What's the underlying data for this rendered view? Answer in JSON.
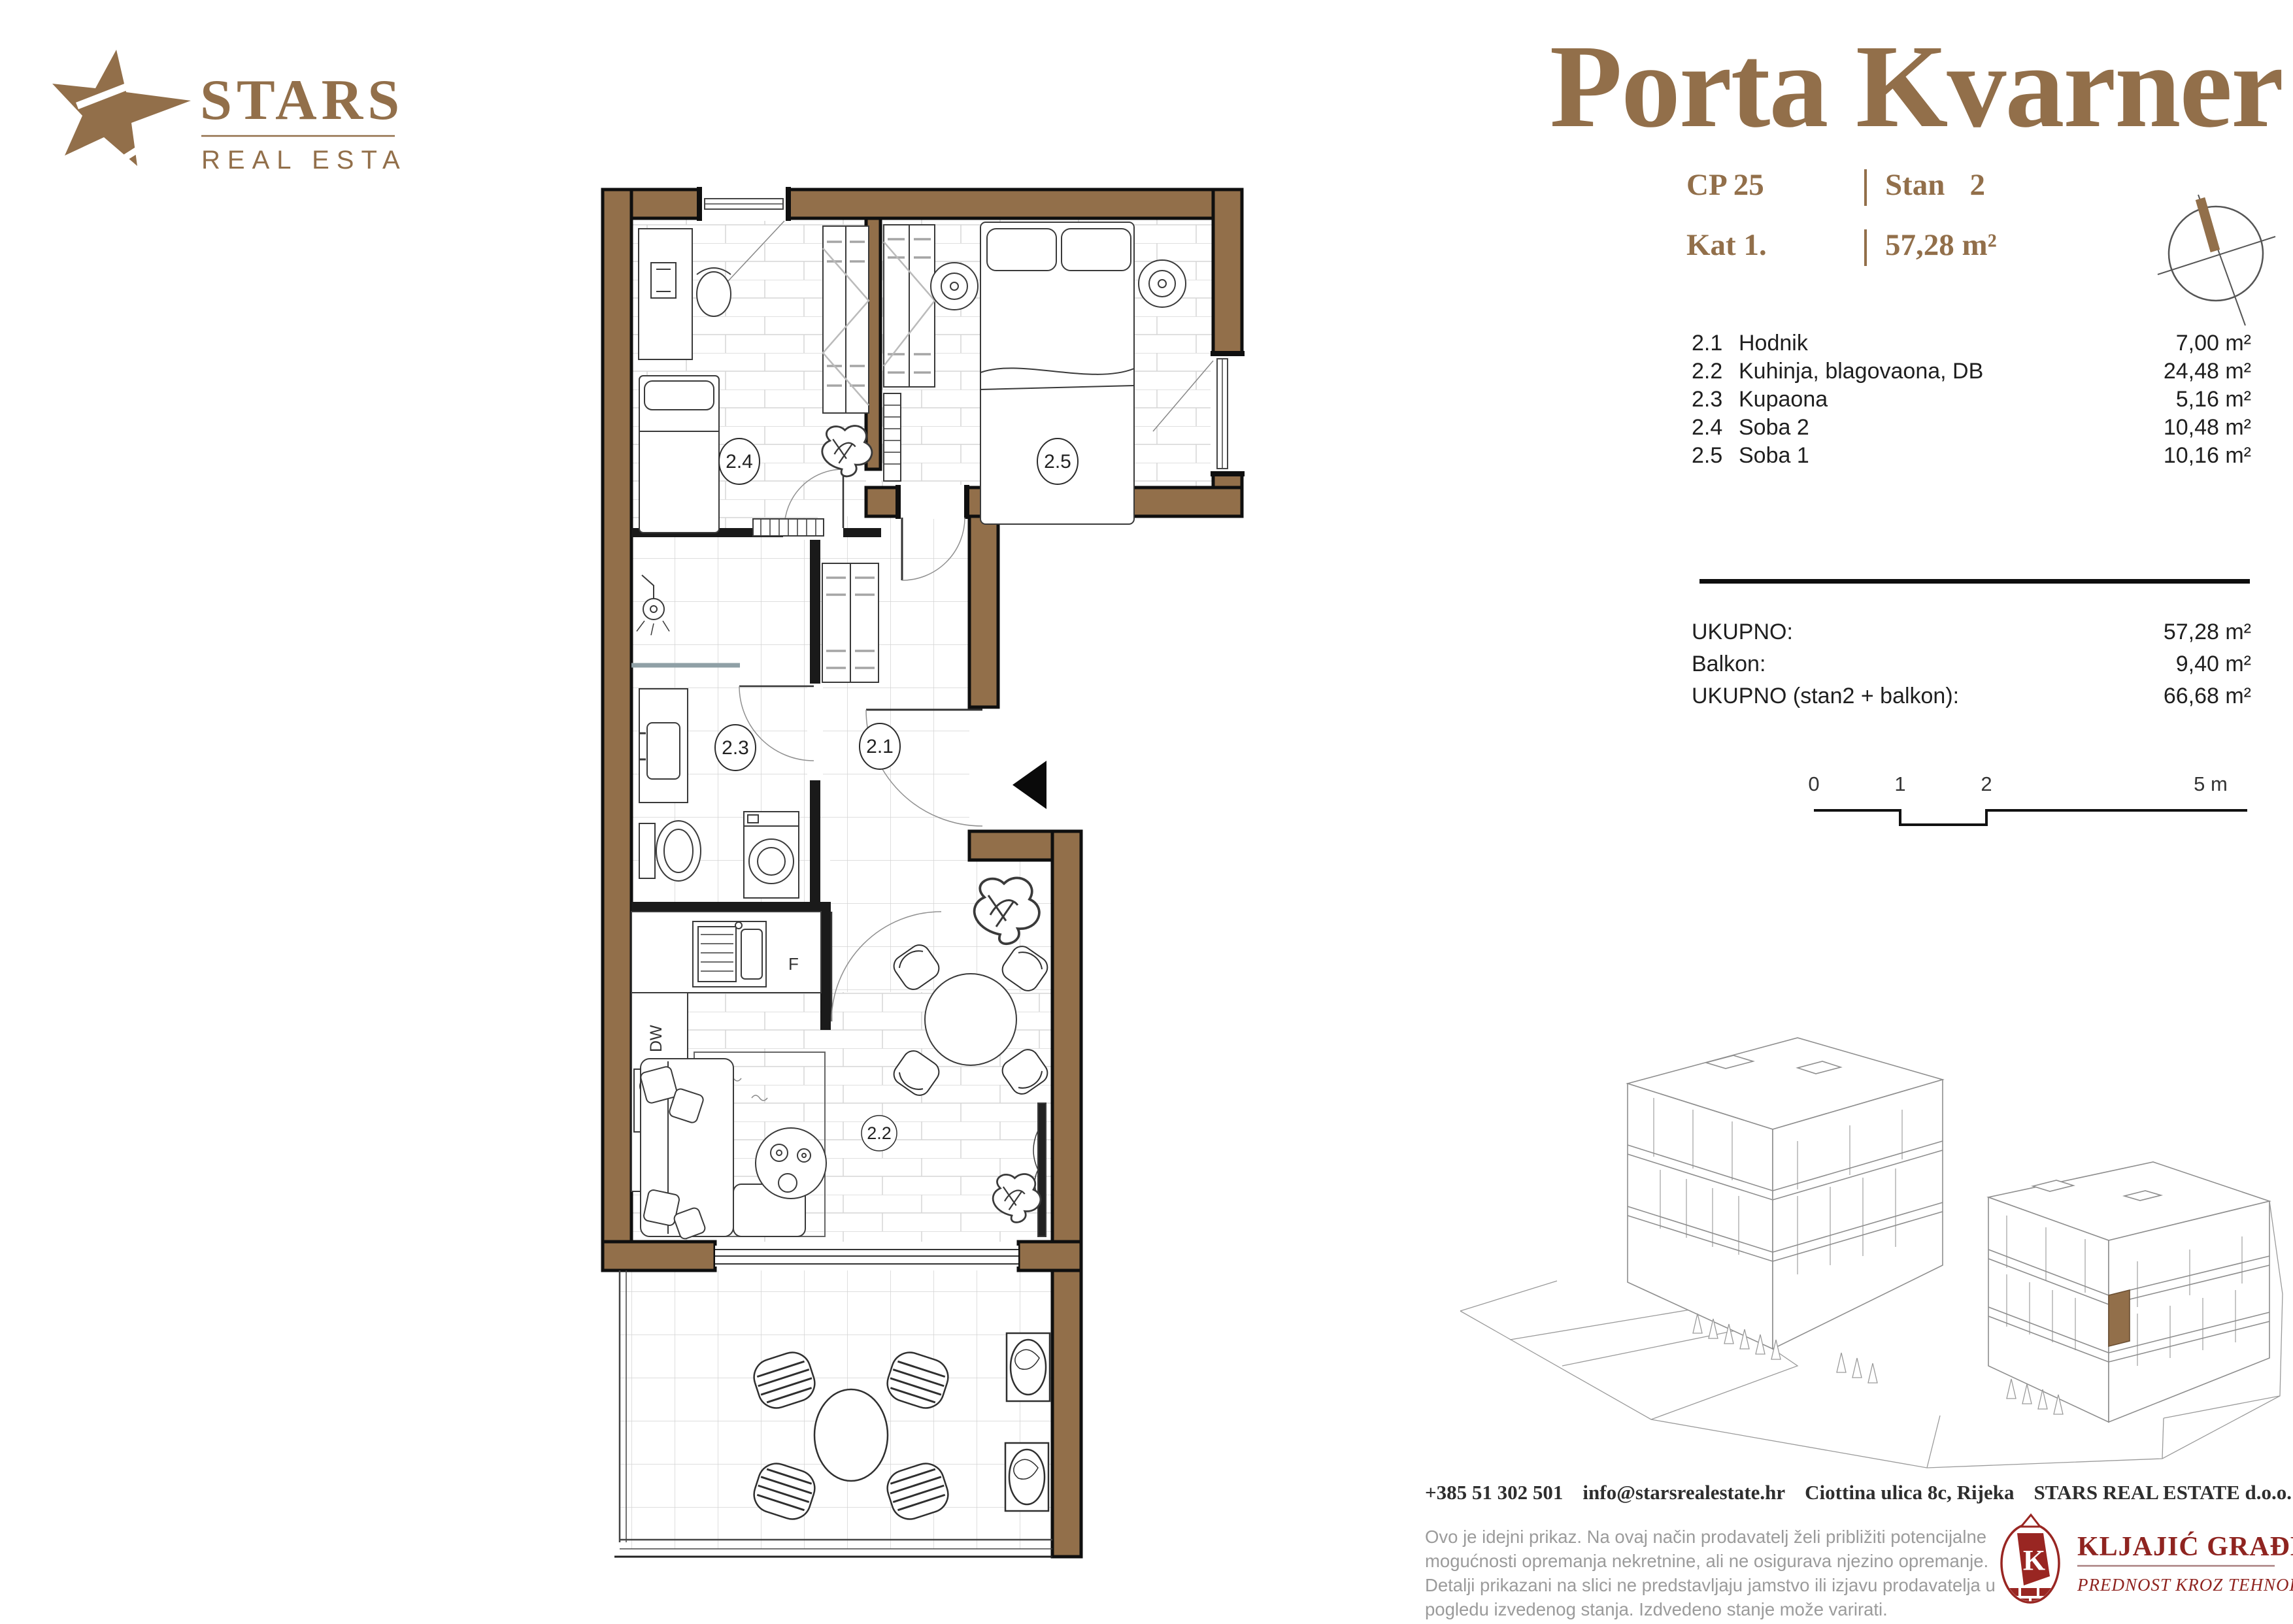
{
  "colors": {
    "accent_brown": "#926f4a",
    "wall_brown": "#926f4a",
    "partner_red": "#8f2420",
    "text_dark": "#1f1f1f",
    "muted_gray": "#9b9b9b"
  },
  "brand": {
    "name": "STARS",
    "tagline": "REAL ESTATE"
  },
  "header": {
    "title": "Porta Kvarner"
  },
  "unit": {
    "code_label": "CP 25",
    "stan_label": "Stan",
    "stan_value": "2",
    "floor": "Kat 1.",
    "area": "57,28 m²"
  },
  "rooms": [
    {
      "no": "2.1",
      "name": "Hodnik",
      "area": "7,00 m²"
    },
    {
      "no": "2.2",
      "name": "Kuhinja, blagovaona, DB",
      "area": "24,48 m²"
    },
    {
      "no": "2.3",
      "name": "Kupaona",
      "area": "5,16 m²"
    },
    {
      "no": "2.4",
      "name": "Soba 2",
      "area": "10,48 m²"
    },
    {
      "no": "2.5",
      "name": "Soba 1",
      "area": "10,16 m²"
    }
  ],
  "totals": [
    {
      "label": "UKUPNO:",
      "value": "57,28 m²"
    },
    {
      "label": "Balkon:",
      "value": "9,40 m²"
    },
    {
      "label": "UKUPNO (stan2 + balkon):",
      "value": "66,68 m²"
    }
  ],
  "scalebar": {
    "t0": "0",
    "t1": "1",
    "t2": "2",
    "t5": "5 m"
  },
  "plan_labels": {
    "hall": "2.1",
    "living": "2.2",
    "bath": "2.3",
    "room2": "2.4",
    "room1": "2.5",
    "fridge": "F",
    "dishwasher": "DW"
  },
  "footer": {
    "phone": "+385 51 302 501",
    "email": "info@starsrealestate.hr",
    "address": "Ciottina ulica 8c, Rijeka",
    "company": "STARS REAL ESTATE d.o.o.",
    "disclaimer": "Ovo je idejni prikaz. Na ovaj način prodavatelj želi približiti potencijalne mogućnosti opremanja nekretnine, ali ne osigurava njezino opremanje. Detalji prikazani na slici ne predstavljaju jamstvo ili izjavu prodavatelja u pogledu izvedenog stanja. Izdvedeno stanje može varirati."
  },
  "partner": {
    "monogram": "K",
    "name": "KLJAJIĆ GRAĐENJE",
    "tagline": "PREDNOST KROZ TEHNOLOGIJU"
  }
}
